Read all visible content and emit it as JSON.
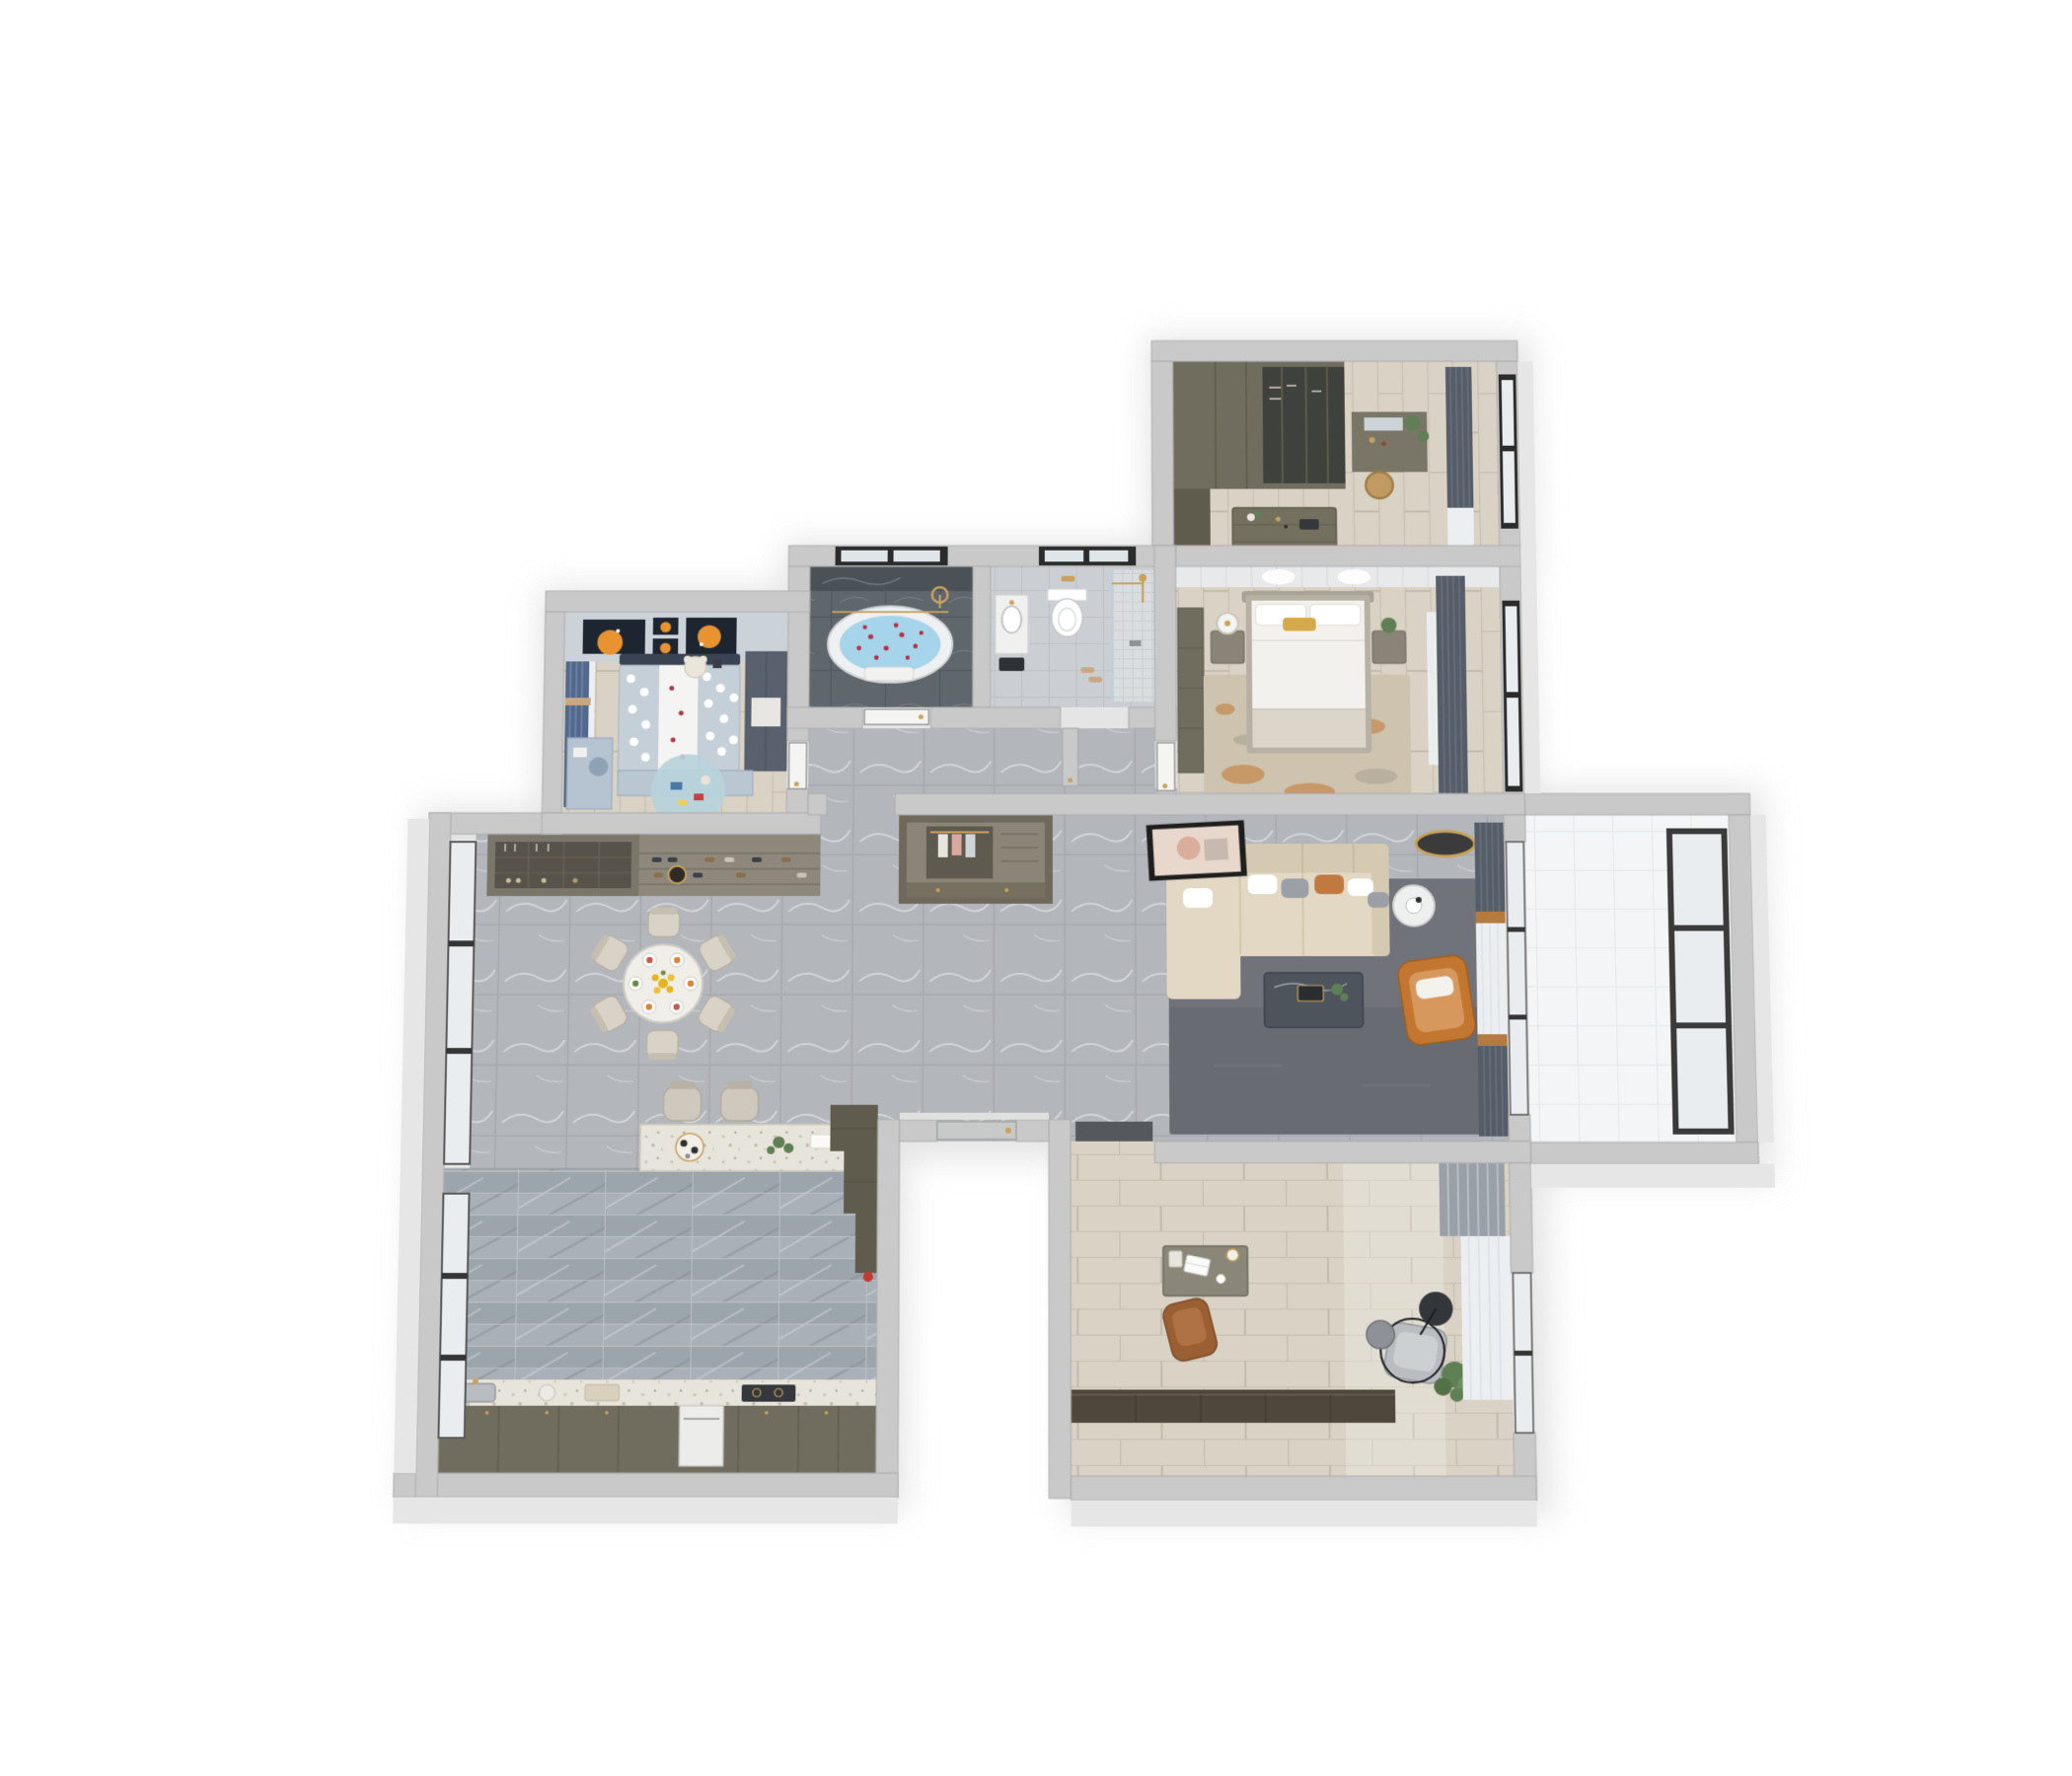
{
  "scene": {
    "kind": "3d-floorplan-render",
    "view": "top-down-cutaway",
    "background": "#ffffff"
  },
  "palette": {
    "wall": "#c9c9c9",
    "wall_face": "#e6e6e6",
    "floor_marble": "#b3b6bb",
    "floor_marble_line": "#a4a7ac",
    "floor_wood": "#d9d2c5",
    "floor_wood_line": "#c8c0b1",
    "floor_dark": "#5f666c",
    "floor_wc": "#cbcfd3",
    "floor_kitchen_a": "#a9b0b7",
    "floor_kitchen_b": "#99a1a8",
    "floor_balcony": "#f3f5f6",
    "glass": "#e9edf0",
    "frame_dark": "#353535",
    "sofa_beige": "#e2d8c3",
    "sofa_beige_dark": "#d5cab1",
    "rug_living": "#70737a",
    "rug_master": "#cdc3ae",
    "accent_orange": "#c3762f",
    "accent_rust": "#c07a40",
    "accent_gold": "#c9a25e",
    "cabinet_olive": "#716d5e",
    "cabinet_olive_dark": "#605c4d",
    "cabinet_dark": "#4f463c",
    "curtain_dark": "#545d68",
    "curtain_blue": "#52688c",
    "sheer": "#eceff2",
    "water": "#a6d4ea",
    "petal": "#b23148",
    "linen_white": "#f2f1ed",
    "kids_blanket": "#c5cfd8",
    "art_navy": "#1d2531",
    "art_orange": "#e8932f",
    "plant_green": "#5f7f55",
    "door_leaf": "#f4f4f2"
  },
  "counts": {
    "dining_chairs": 6,
    "table_settings": 6,
    "bar_stools": 2,
    "kids_art_frames": 4,
    "living_throw_pillows": 6,
    "bedrooms": 3,
    "bathrooms": 2
  },
  "rooms": [
    {
      "name": "walk-in-closet",
      "floor": "light-wood-plank",
      "items": [
        "wardrobe-run",
        "glass-wardrobe",
        "island-dresser",
        "vanity-with-mirror",
        "rattan-basket",
        "dark-curtains",
        "windows"
      ]
    },
    {
      "name": "master-bedroom",
      "floor": "light-wood-plank",
      "items": [
        "double-bed",
        "white-bedding",
        "gold-accent-pillow",
        "nightstand-left",
        "table-lamp",
        "nightstand-right",
        "plant",
        "orange-flecked-rug",
        "wardrobe-cabinet",
        "dark-curtains",
        "windows"
      ]
    },
    {
      "name": "bathroom",
      "floor": "dark-marble-tile",
      "items": [
        "freestanding-oval-bathtub",
        "rose-petals",
        "gold-shower-set",
        "gold-towel-rail",
        "bath-towel",
        "window"
      ]
    },
    {
      "name": "shower-room",
      "floor": "light-gray-tile",
      "items": [
        "wall-hung-toilet",
        "vanity-basin",
        "glass-shower-screen",
        "gold-shower-set",
        "shower-tile-floor",
        "window"
      ]
    },
    {
      "name": "kids-bedroom",
      "floor": "light-wood-plank",
      "items": [
        "single-bed",
        "polka-dot-bedding",
        "teddy-bear",
        "moon-art-frames",
        "wardrobe",
        "study-desk",
        "round-play-rug",
        "blue-curtains",
        "low-dressers"
      ]
    },
    {
      "name": "dining-room",
      "floor": "gray-marble-tile",
      "items": [
        "round-dining-table",
        "dining-chairs",
        "plate-settings",
        "yellow-flower-centerpiece",
        "pendant-light",
        "wine-cabinet",
        "shoe-shelves",
        "windows"
      ]
    },
    {
      "name": "kitchen",
      "floor": "striped-gray-tile",
      "items": [
        "island-counter",
        "bar-stools",
        "coffee-tray",
        "plant",
        "stepped-pantry-column",
        "sink",
        "gold-faucet",
        "cooktop",
        "built-in-oven",
        "base-cabinets",
        "windows"
      ]
    },
    {
      "name": "hallway",
      "floor": "gray-marble-tile",
      "items": [
        "entry-closet",
        "entry-door",
        "interior-doors",
        "corridor-nook"
      ]
    },
    {
      "name": "living-room",
      "floor": "gray-marble-tile",
      "items": [
        "sectional-sofa",
        "throw-pillows",
        "marble-coffee-table",
        "dark-gray-rug",
        "orange-accent-armchair",
        "round-side-table",
        "leaning-art-frame",
        "round-ceiling-light",
        "curtains-and-sheers",
        "sliding-window"
      ]
    },
    {
      "name": "balcony",
      "floor": "white-tile",
      "items": [
        "panorama-window"
      ]
    },
    {
      "name": "study",
      "floor": "light-wood-plank",
      "items": [
        "writing-desk",
        "laptop",
        "desk-lamp",
        "leather-office-chair",
        "lounge-chair",
        "arc-floor-lamp",
        "round-side-table",
        "potted-plant",
        "media-cabinet",
        "curtains",
        "window",
        "door-mat"
      ]
    }
  ]
}
